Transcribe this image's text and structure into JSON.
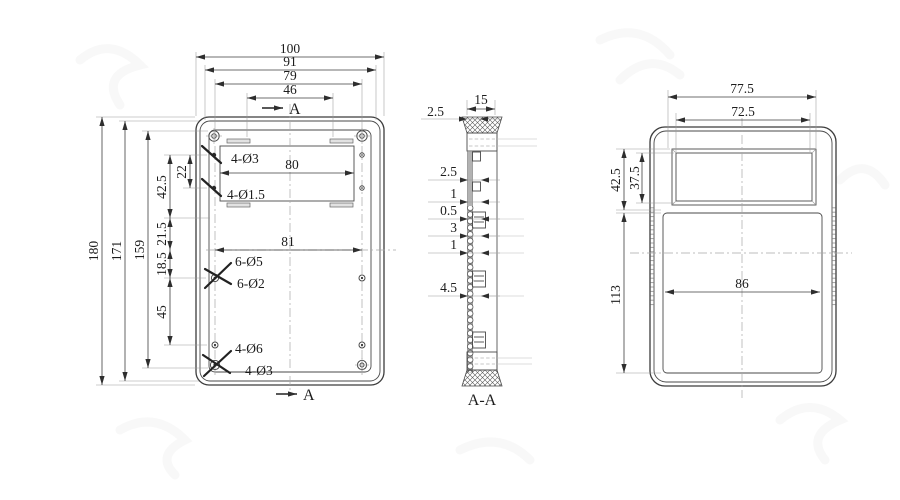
{
  "front_view": {
    "dims": {
      "w100": "100",
      "w91": "91",
      "w79": "79",
      "w46": "46",
      "h180": "180",
      "h171": "171",
      "h159": "159",
      "h42_5": "42.5",
      "h22": "22",
      "h21_5": "21.5",
      "h18_5": "18.5",
      "h45": "45",
      "slot80": "80",
      "mid81": "81"
    },
    "holes": {
      "top": "4-Ø3",
      "slot": "4-Ø1.5",
      "mid_outer": "6-Ø5",
      "mid_inner": "6-Ø2",
      "bottom_outer": "4-Ø6",
      "bottom_inner": "4-Ø3"
    },
    "section_marker": "A"
  },
  "section_view": {
    "label": "A-A",
    "dims": {
      "t2_5": "2.5",
      "t15": "15",
      "s2_5": "2.5",
      "s1a": "1",
      "s0_5": "0.5",
      "s3": "3",
      "s1b": "1",
      "s4_5": "4.5"
    }
  },
  "side_view": {
    "dims": {
      "w77_5": "77.5",
      "w72_5": "72.5",
      "h42_5": "42.5",
      "h37_5": "37.5",
      "h113": "113",
      "w86": "86"
    }
  }
}
